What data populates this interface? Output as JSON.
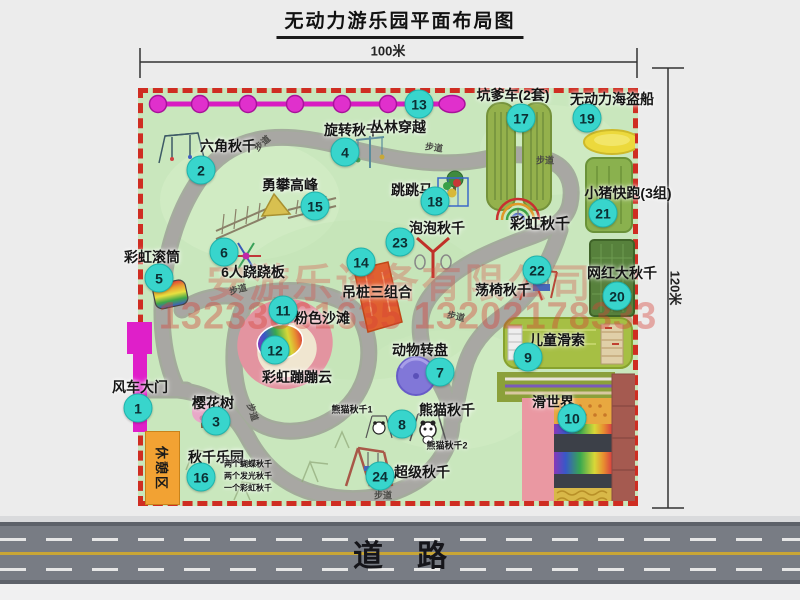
{
  "title": "无动力游乐园平面布局图",
  "dimensions": {
    "width": "100米",
    "height": "120米"
  },
  "road": {
    "label": "道路"
  },
  "watermark": {
    "company": "安游乐设备有限公司",
    "phone": "13233861635 13202178333"
  },
  "rest_area": {
    "label": "休憩区"
  },
  "colors": {
    "map_green": "#c9e7bd",
    "border_red": "#cf2d22",
    "badge_teal": "#38d5cc",
    "path_gray": "#a8a7a3",
    "gate_magenta": "#df1fc9",
    "rest_orange": "#f2a233",
    "beach_pink": "#e394a0",
    "boat_yellow": "#ecd93c"
  },
  "facilities": [
    {
      "num": "1",
      "label": "风车大门",
      "bx": 138,
      "by": 408,
      "lx": 140,
      "ly": 387
    },
    {
      "num": "2",
      "label": "六角秋千",
      "bx": 201,
      "by": 170,
      "lx": 228,
      "ly": 146
    },
    {
      "num": "3",
      "label": "樱花树",
      "bx": 216,
      "by": 421,
      "lx": 213,
      "ly": 403
    },
    {
      "num": "4",
      "label": "旋转秋千",
      "bx": 345,
      "by": 152,
      "lx": 352,
      "ly": 130
    },
    {
      "num": "5",
      "label": "彩虹滚筒",
      "bx": 159,
      "by": 278,
      "lx": 152,
      "ly": 257
    },
    {
      "num": "6",
      "label": "6人跷跷板",
      "bx": 224,
      "by": 252,
      "lx": 253,
      "ly": 272
    },
    {
      "num": "7",
      "label": "动物转盘",
      "bx": 440,
      "by": 372,
      "lx": 420,
      "ly": 350
    },
    {
      "num": "8",
      "label": "熊猫秋千",
      "bx": 402,
      "by": 424,
      "lx": 447,
      "ly": 410
    },
    {
      "num": "9",
      "label": "儿童滑索",
      "bx": 528,
      "by": 357,
      "lx": 557,
      "ly": 340
    },
    {
      "num": "10",
      "label": "滑世界",
      "bx": 572,
      "by": 418,
      "lx": 553,
      "ly": 402
    },
    {
      "num": "11",
      "label": "粉色沙滩",
      "bx": 283,
      "by": 310,
      "lx": 322,
      "ly": 318
    },
    {
      "num": "12",
      "label": "彩虹蹦蹦云",
      "bx": 275,
      "by": 350,
      "lx": 297,
      "ly": 377
    },
    {
      "num": "13",
      "label": "丛林穿越",
      "bx": 419,
      "by": 104,
      "lx": 398,
      "ly": 127
    },
    {
      "num": "14",
      "label": "吊桩三组合",
      "bx": 361,
      "by": 262,
      "lx": 377,
      "ly": 292
    },
    {
      "num": "15",
      "label": "勇攀高峰",
      "bx": 315,
      "by": 206,
      "lx": 290,
      "ly": 185
    },
    {
      "num": "16",
      "label": "秋千乐园",
      "bx": 201,
      "by": 477,
      "lx": 216,
      "ly": 457
    },
    {
      "num": "17",
      "label": "坑爹车(2套)",
      "bx": 521,
      "by": 118,
      "lx": 513,
      "ly": 95
    },
    {
      "num": "18",
      "label": "跳跳马",
      "bx": 435,
      "by": 201,
      "lx": 412,
      "ly": 190
    },
    {
      "num": "19",
      "label": "无动力海盗船",
      "bx": 587,
      "by": 118,
      "lx": 612,
      "ly": 99
    },
    {
      "num": "20",
      "label": "网红大秋千",
      "bx": 617,
      "by": 296,
      "lx": 622,
      "ly": 273
    },
    {
      "num": "21",
      "label": "小猪快跑(3组)",
      "bx": 603,
      "by": 213,
      "lx": 628,
      "ly": 193
    },
    {
      "num": "22",
      "label": "荡椅秋千",
      "bx": 537,
      "by": 270,
      "lx": 503,
      "ly": 290
    },
    {
      "num": "23",
      "label": "泡泡秋千",
      "bx": 400,
      "by": 242,
      "lx": 437,
      "ly": 228
    },
    {
      "num": "24",
      "label": "超级秋千",
      "bx": 380,
      "by": 476,
      "lx": 422,
      "ly": 472
    }
  ],
  "extra_labels": [
    {
      "text": "彩虹秋千",
      "x": 540,
      "y": 223,
      "fs": 15,
      "bold": true
    },
    {
      "text": "熊猫秋千1",
      "x": 352,
      "y": 409,
      "fs": 9
    },
    {
      "text": "熊猫秋千2",
      "x": 447,
      "y": 445,
      "fs": 9
    },
    {
      "text": "两个蝴蝶秋千",
      "x": 224,
      "y": 464,
      "fs": 8,
      "anchor": "left"
    },
    {
      "text": "两个发光秋千",
      "x": 224,
      "y": 476,
      "fs": 8,
      "anchor": "left"
    },
    {
      "text": "一个彩虹秋千",
      "x": 224,
      "y": 488,
      "fs": 8,
      "anchor": "left"
    }
  ],
  "path_labels": [
    {
      "text": "步道",
      "x": 262,
      "y": 143,
      "rot": -42
    },
    {
      "text": "步道",
      "x": 434,
      "y": 147,
      "rot": 8
    },
    {
      "text": "步道",
      "x": 545,
      "y": 160,
      "rot": 0
    },
    {
      "text": "步道",
      "x": 238,
      "y": 289,
      "rot": -15
    },
    {
      "text": "步道",
      "x": 253,
      "y": 412,
      "rot": 72
    },
    {
      "text": "步道",
      "x": 456,
      "y": 316,
      "rot": 12
    },
    {
      "text": "步道",
      "x": 383,
      "y": 495,
      "rot": 0
    }
  ]
}
